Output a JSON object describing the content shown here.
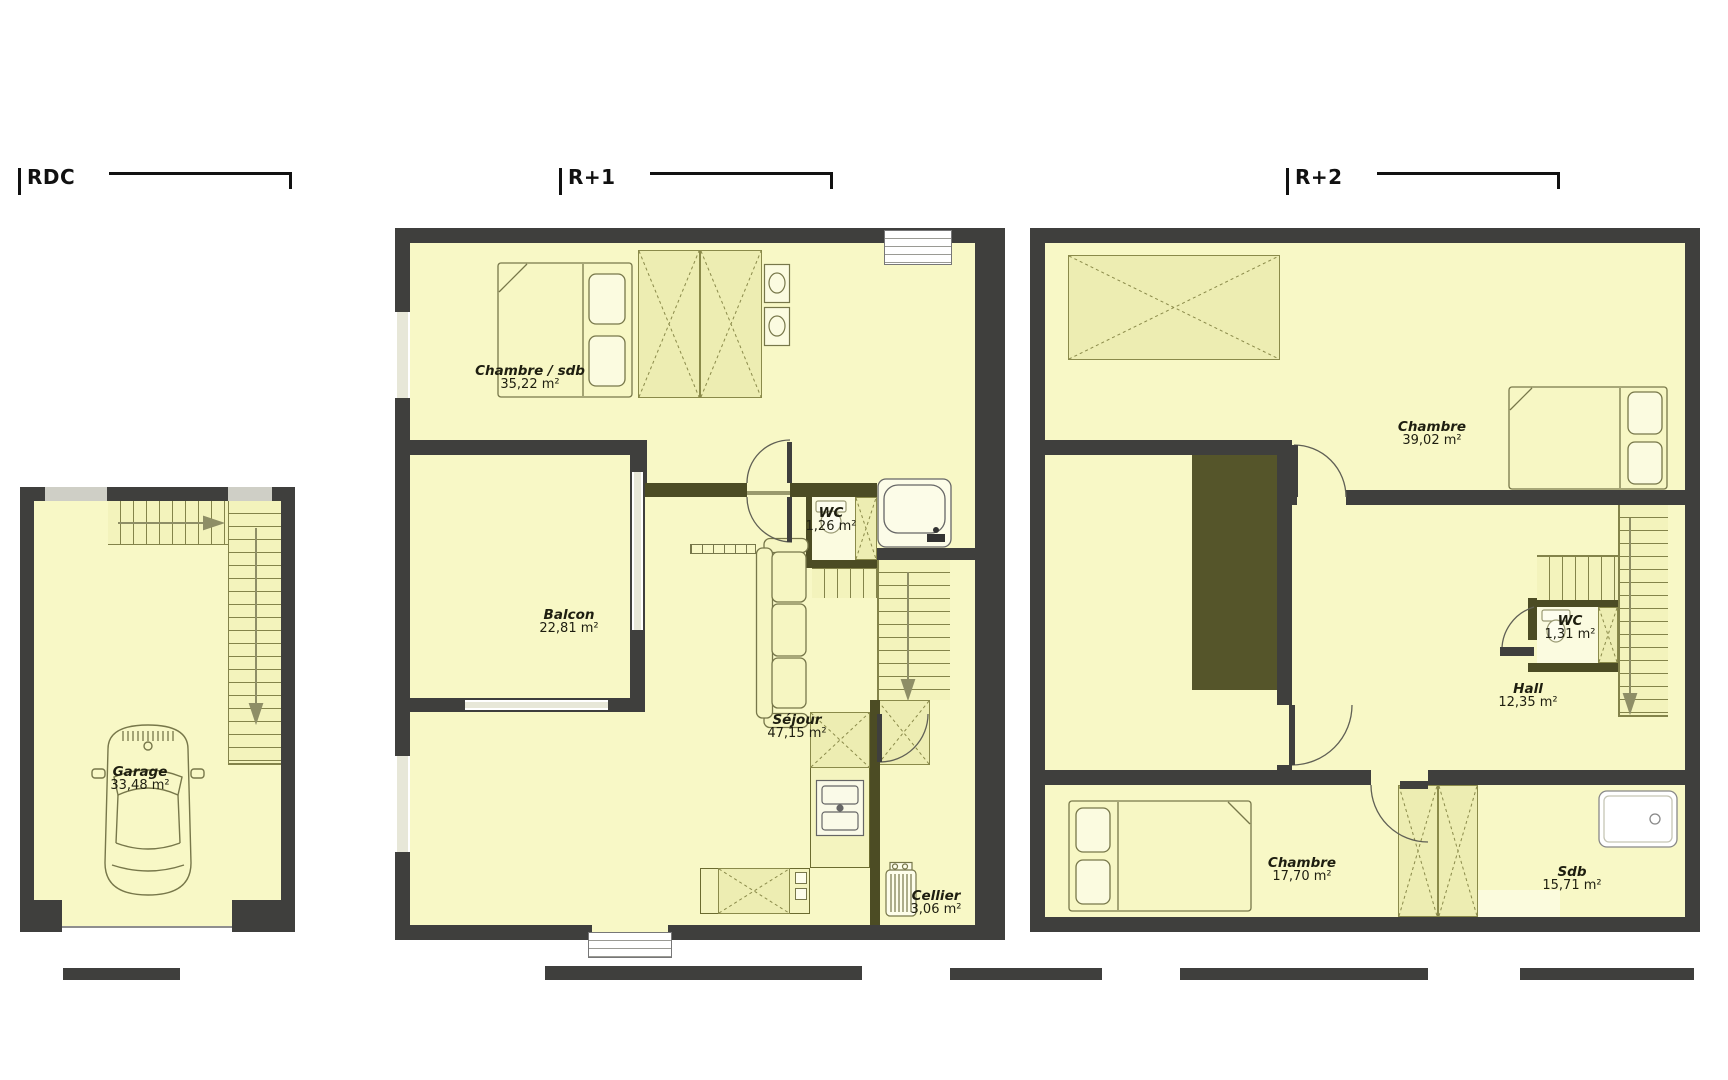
{
  "document": {
    "type": "floor-plans",
    "background": "#ffffff"
  },
  "colors": {
    "wall": "#3f3f3d",
    "interior_wall": "#4c4c24",
    "floor": "#f8f8c6",
    "hatch_bg": "#ededb2",
    "hatch_line": "#8a8a4a",
    "stair_bg": "#f3f3bc",
    "stair_line": "#83834a",
    "window": "#e7e7d8",
    "furniture_line": "#77774a",
    "label_text": "#1e1e10"
  },
  "plans": [
    {
      "id": "rdc",
      "title": "RDC",
      "rooms": [
        {
          "name": "Garage",
          "area": "33,48 m²",
          "x": 140,
          "y": 765
        }
      ]
    },
    {
      "id": "r1",
      "title": "R+1",
      "rooms": [
        {
          "name": "Chambre / sdb",
          "area": "35,22 m²",
          "x": 530,
          "y": 364
        },
        {
          "name": "WC",
          "area": "1,26 m²",
          "x": 831,
          "y": 506
        },
        {
          "name": "Balcon",
          "area": "22,81 m²",
          "x": 569,
          "y": 608
        },
        {
          "name": "Séjour",
          "area": "47,15 m²",
          "x": 797,
          "y": 713
        },
        {
          "name": "Cellier",
          "area": "3,06 m²",
          "x": 936,
          "y": 889
        }
      ]
    },
    {
      "id": "r2",
      "title": "R+2",
      "rooms": [
        {
          "name": "Chambre",
          "area": "39,02 m²",
          "x": 1432,
          "y": 420
        },
        {
          "name": "WC",
          "area": "1,31 m²",
          "x": 1570,
          "y": 614
        },
        {
          "name": "Hall",
          "area": "12,35 m²",
          "x": 1528,
          "y": 682
        },
        {
          "name": "Chambre",
          "area": "17,70 m²",
          "x": 1302,
          "y": 856
        },
        {
          "name": "Sdb",
          "area": "15,71 m²",
          "x": 1572,
          "y": 865
        }
      ]
    }
  ]
}
